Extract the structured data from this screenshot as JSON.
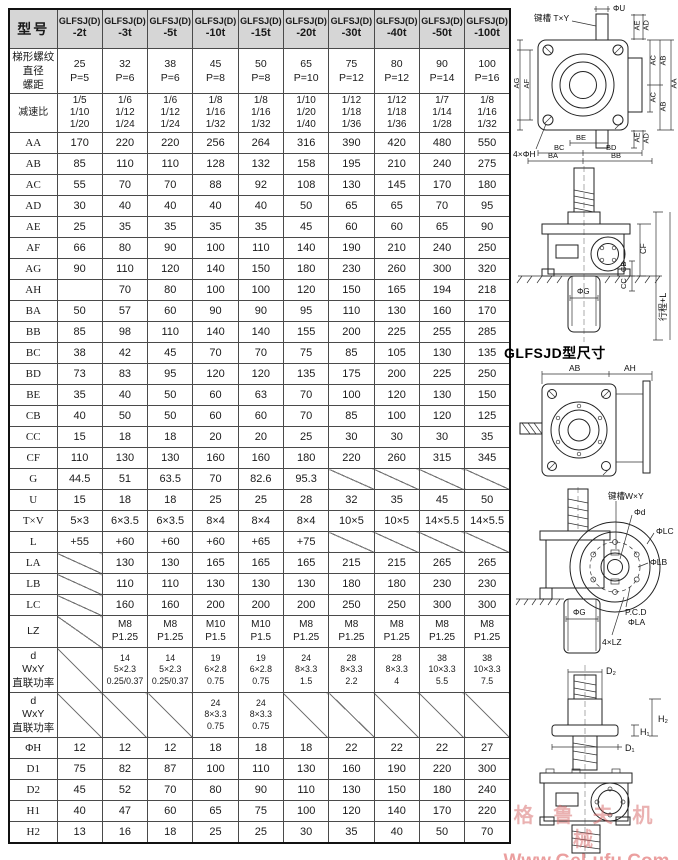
{
  "table": {
    "corner_label": "型号",
    "col_prefix": "GLFSJ(D)",
    "columns": [
      "-2t",
      "-3t",
      "-5t",
      "-10t",
      "-15t",
      "-20t",
      "-30t",
      "-40t",
      "-50t",
      "-100t"
    ],
    "rows": [
      {
        "label": "梯形螺纹\n直径\n螺距",
        "cls": "r-thread",
        "cells": [
          "25\nP=5",
          "32\nP=6",
          "38\nP=6",
          "45\nP=8",
          "50\nP=8",
          "65\nP=10",
          "75\nP=12",
          "80\nP=12",
          "90\nP=14",
          "100\nP=16"
        ]
      },
      {
        "label": "减速比",
        "cls": "r-ratio",
        "cells": [
          "1/5\n1/10\n1/20",
          "1/6\n1/12\n1/24",
          "1/6\n1/12\n1/24",
          "1/8\n1/16\n1/32",
          "1/8\n1/16\n1/32",
          "1/10\n1/20\n1/40",
          "1/12\n1/18\n1/36",
          "1/12\n1/18\n1/36",
          "1/7\n1/14\n1/28",
          "1/8\n1/16\n1/32"
        ]
      },
      {
        "label": "AA",
        "cls": "r-std",
        "cells": [
          "170",
          "220",
          "220",
          "256",
          "264",
          "316",
          "390",
          "420",
          "480",
          "550"
        ]
      },
      {
        "label": "AB",
        "cls": "r-std",
        "cells": [
          "85",
          "110",
          "110",
          "128",
          "132",
          "158",
          "195",
          "210",
          "240",
          "275"
        ]
      },
      {
        "label": "AC",
        "cls": "r-std",
        "cells": [
          "55",
          "70",
          "70",
          "88",
          "92",
          "108",
          "130",
          "145",
          "170",
          "180"
        ]
      },
      {
        "label": "AD",
        "cls": "r-std",
        "cells": [
          "30",
          "40",
          "40",
          "40",
          "40",
          "50",
          "65",
          "65",
          "70",
          "95"
        ]
      },
      {
        "label": "AE",
        "cls": "r-std",
        "cells": [
          "25",
          "35",
          "35",
          "35",
          "35",
          "45",
          "60",
          "60",
          "65",
          "90"
        ]
      },
      {
        "label": "AF",
        "cls": "r-std",
        "cells": [
          "66",
          "80",
          "90",
          "100",
          "110",
          "140",
          "190",
          "210",
          "240",
          "250"
        ]
      },
      {
        "label": "AG",
        "cls": "r-std",
        "cells": [
          "90",
          "110",
          "120",
          "140",
          "150",
          "180",
          "230",
          "260",
          "300",
          "320"
        ]
      },
      {
        "label": "AH",
        "cls": "r-std",
        "cells": [
          "",
          "70",
          "80",
          "100",
          "100",
          "120",
          "150",
          "165",
          "194",
          "218"
        ]
      },
      {
        "label": "BA",
        "cls": "r-std",
        "cells": [
          "50",
          "57",
          "60",
          "90",
          "90",
          "95",
          "110",
          "130",
          "160",
          "170"
        ]
      },
      {
        "label": "BB",
        "cls": "r-std",
        "cells": [
          "85",
          "98",
          "110",
          "140",
          "140",
          "155",
          "200",
          "225",
          "255",
          "285"
        ]
      },
      {
        "label": "BC",
        "cls": "r-std",
        "cells": [
          "38",
          "42",
          "45",
          "70",
          "70",
          "75",
          "85",
          "105",
          "130",
          "135"
        ]
      },
      {
        "label": "BD",
        "cls": "r-std",
        "cells": [
          "73",
          "83",
          "95",
          "120",
          "120",
          "135",
          "175",
          "200",
          "225",
          "250"
        ]
      },
      {
        "label": "BE",
        "cls": "r-std",
        "cells": [
          "35",
          "40",
          "50",
          "60",
          "63",
          "70",
          "100",
          "120",
          "130",
          "150"
        ]
      },
      {
        "label": "CB",
        "cls": "r-std",
        "cells": [
          "40",
          "50",
          "50",
          "60",
          "60",
          "70",
          "85",
          "100",
          "120",
          "125"
        ]
      },
      {
        "label": "CC",
        "cls": "r-std",
        "cells": [
          "15",
          "18",
          "18",
          "20",
          "20",
          "25",
          "30",
          "30",
          "30",
          "35"
        ]
      },
      {
        "label": "CF",
        "cls": "r-std",
        "cells": [
          "110",
          "130",
          "130",
          "160",
          "160",
          "180",
          "220",
          "260",
          "315",
          "345"
        ]
      },
      {
        "label": "G",
        "cls": "r-std",
        "cells": [
          "44.5",
          "51",
          "63.5",
          "70",
          "82.6",
          "95.3",
          "DIAG",
          "DIAG",
          "DIAG",
          "DIAG"
        ]
      },
      {
        "label": "U",
        "cls": "r-std",
        "cells": [
          "15",
          "18",
          "18",
          "25",
          "25",
          "28",
          "32",
          "35",
          "45",
          "50"
        ]
      },
      {
        "label": "T×V",
        "cls": "r-std",
        "cells": [
          "5×3",
          "6×3.5",
          "6×3.5",
          "8×4",
          "8×4",
          "8×4",
          "10×5",
          "10×5",
          "14×5.5",
          "14×5.5"
        ]
      },
      {
        "label": "L",
        "cls": "r-std",
        "cells": [
          "+55",
          "+60",
          "+60",
          "+60",
          "+65",
          "+75",
          "DIAG",
          "DIAG",
          "DIAG",
          "DIAG"
        ]
      },
      {
        "label": "LA",
        "cls": "r-std",
        "cells": [
          "DIAG",
          "130",
          "130",
          "165",
          "165",
          "165",
          "215",
          "215",
          "265",
          "265"
        ]
      },
      {
        "label": "LB",
        "cls": "r-std",
        "cells": [
          "DIAG",
          "110",
          "110",
          "130",
          "130",
          "130",
          "180",
          "180",
          "230",
          "230"
        ]
      },
      {
        "label": "LC",
        "cls": "r-std",
        "cells": [
          "DIAG",
          "160",
          "160",
          "200",
          "200",
          "200",
          "250",
          "250",
          "300",
          "300"
        ]
      },
      {
        "label": "LZ",
        "cls": "r-lz",
        "cells": [
          "DIAG",
          "M8\nP1.25",
          "M8\nP1.25",
          "M10\nP1.5",
          "M10\nP1.5",
          "M8\nP1.25",
          "M8\nP1.25",
          "M8\nP1.25",
          "M8\nP1.25",
          "M8\nP1.25"
        ]
      },
      {
        "label": "d\nWxY\n直联功率",
        "cls": "r-d",
        "cells": [
          "DIAG",
          "14\n5×2.3\n0.25/0.37",
          "14\n5×2.3\n0.25/0.37",
          "19\n6×2.8\n0.75",
          "19\n6×2.8\n0.75",
          "24\n8×3.3\n1.5",
          "28\n8×3.3\n2.2",
          "28\n8×3.3\n4",
          "38\n10×3.3\n5.5",
          "38\n10×3.3\n7.5"
        ]
      },
      {
        "label": "d\nWxY\n直联功率",
        "cls": "r-d",
        "cells": [
          "DIAG",
          "DIAG",
          "DIAG",
          "24\n8×3.3\n0.75",
          "24\n8×3.3\n0.75",
          "DIAG",
          "DIAG",
          "DIAG",
          "DIAG",
          "DIAG"
        ]
      },
      {
        "label": "ΦH",
        "cls": "r-std",
        "cells": [
          "12",
          "12",
          "12",
          "18",
          "18",
          "18",
          "22",
          "22",
          "22",
          "27"
        ]
      },
      {
        "label": "D1",
        "cls": "r-std",
        "cells": [
          "75",
          "82",
          "87",
          "100",
          "110",
          "130",
          "160",
          "190",
          "220",
          "300"
        ]
      },
      {
        "label": "D2",
        "cls": "r-std",
        "cells": [
          "45",
          "52",
          "70",
          "80",
          "90",
          "110",
          "130",
          "150",
          "180",
          "240"
        ]
      },
      {
        "label": "H1",
        "cls": "r-std",
        "cells": [
          "40",
          "47",
          "60",
          "65",
          "75",
          "100",
          "120",
          "140",
          "170",
          "220"
        ]
      },
      {
        "label": "H2",
        "cls": "r-std",
        "cells": [
          "13",
          "16",
          "18",
          "25",
          "25",
          "30",
          "35",
          "40",
          "50",
          "70"
        ]
      }
    ]
  },
  "drawings": {
    "top_view": {
      "phi_u": "ΦU",
      "keyway": "键槽 T×Y",
      "ae": "AE",
      "ad": "AD",
      "ac": "AC",
      "ab": "AB",
      "aa": "AA",
      "ag": "AG",
      "af": "AF",
      "holes": "4×ΦH",
      "be": "BE",
      "bc": "BC",
      "bd": "BD",
      "ba": "BA",
      "bb": "BB"
    },
    "side_view": {
      "cf": "CF",
      "cb": "CB",
      "cc": "CC",
      "stroke_cn": "行程+L",
      "stroke_en": "stroke+L",
      "phi_g": "ΦG"
    },
    "glfsjd_title": "GLFSJD型尺寸",
    "glfsjd_front": {
      "ab": "AB",
      "ah": "AH"
    },
    "glfsjd_side": {
      "keyway": "键槽W×Y",
      "phi_d": "Φd",
      "phi_lc": "ΦLC",
      "phi_lb": "ΦLB",
      "pcd": "P.C.D",
      "phi_la": "ΦLA",
      "lz": "4×LZ",
      "phi_g": "ΦG"
    },
    "flange_view": {
      "d2": "D₂",
      "h2": "H₂",
      "h1": "H₁",
      "d1": "D₁"
    }
  },
  "watermark": {
    "line1": "格 鲁 夫 机 械",
    "line2": "Www.GeLufu.Com"
  }
}
